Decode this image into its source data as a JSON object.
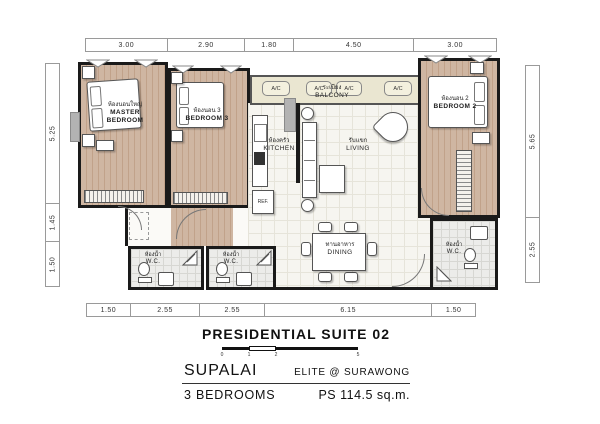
{
  "dimensions": {
    "top": [
      "3.00",
      "2.90",
      "1.80",
      "4.50",
      "3.00"
    ],
    "left": [
      "5.25",
      "1.45",
      "1.50"
    ],
    "right": [
      "5.65",
      "2.55"
    ],
    "bottom": [
      "1.50",
      "2.55",
      "2.55",
      "6.15",
      "1.50"
    ]
  },
  "rooms": {
    "master_bedroom": {
      "thai": "ห้องนอนใหญ่",
      "en_line1": "MASTER",
      "en_line2": "BEDROOM"
    },
    "bedroom_3": {
      "thai": "ห้องนอน 3",
      "en": "BEDROOM 3"
    },
    "bedroom_2": {
      "thai": "ห้องนอน 2",
      "en": "BEDROOM 2"
    },
    "kitchen": {
      "thai": "ห้องครัว",
      "en": "KITCHEN"
    },
    "living": {
      "thai": "รับแขก",
      "en": "LIVING"
    },
    "balcony": {
      "thai": "ระเบียง",
      "en": "BALCONY"
    },
    "dining": {
      "thai": "ทานอาหาร",
      "en": "DINING"
    },
    "wc": {
      "thai": "ห้องน้ำ",
      "en": "W.C."
    }
  },
  "labels": {
    "ac": "A/C",
    "ref": "REF."
  },
  "footer": {
    "title": "PRESIDENTIAL SUITE 02",
    "scale_ticks": [
      "0",
      "1",
      "2",
      "5"
    ],
    "brand": "SUPALAI",
    "project": "ELITE @ SURAWONG",
    "bedrooms": "3 BEDROOMS",
    "area": "PS 114.5 sq.m."
  },
  "colors": {
    "wall": "#1a1a1a",
    "wood_floor": "#cbb09a",
    "balcony_floor": "#eae6d1",
    "open_floor": "#f6f5f0",
    "tile_floor": "#ececea"
  }
}
